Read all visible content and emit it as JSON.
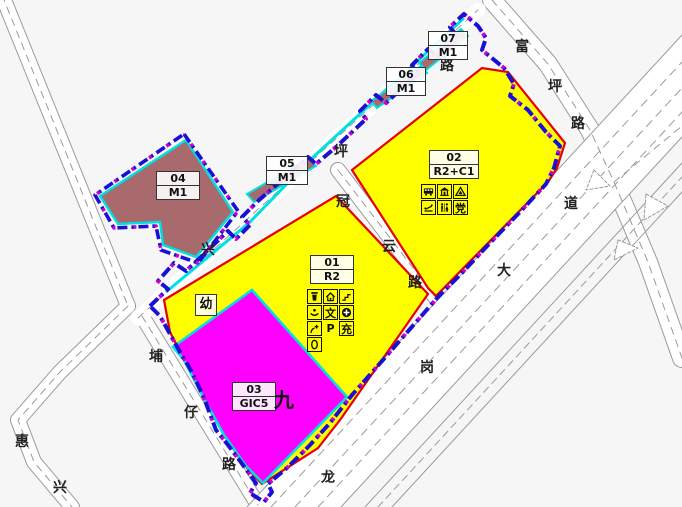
{
  "map_type": "land-use zoning plan",
  "parcels": [
    {
      "number": "01",
      "code": "R2",
      "fill": "#ffff00",
      "outline": "#e60000"
    },
    {
      "number": "02",
      "code": "R2+C1",
      "fill": "#ffff00",
      "outline": "#e60000"
    },
    {
      "number": "03",
      "code": "GIC5",
      "fill": "#ff00ff",
      "outline": "#00e0e0"
    },
    {
      "number": "04",
      "code": "M1",
      "fill": "#a96a6e",
      "outline": "#00e0e0"
    },
    {
      "number": "05",
      "code": "M1",
      "fill": "#a96a6e",
      "outline": "#00e0e0"
    },
    {
      "number": "06",
      "code": "M1",
      "fill": "#a96a6e",
      "outline": "#00e0e0"
    },
    {
      "number": "07",
      "code": "M1",
      "fill": "#a96a6e",
      "outline": "#00e0e0"
    }
  ],
  "roads": {
    "xingping": {
      "chars": [
        "兴",
        "坪",
        "路"
      ]
    },
    "guanyun": {
      "chars": [
        "冠",
        "云",
        "路"
      ]
    },
    "fuping": {
      "chars": [
        "富",
        "坪",
        "路"
      ]
    },
    "longgang": {
      "chars": [
        "龙",
        "岗",
        "大",
        "道"
      ]
    },
    "puzai": {
      "chars": [
        "埔",
        "仔",
        "路"
      ]
    },
    "huixing": {
      "chars": [
        "惠",
        "兴"
      ]
    }
  },
  "annotations": {
    "kindergarten": "幼",
    "school_nine": "九"
  },
  "facilities": {
    "parcel01": {
      "culture": "文",
      "parking": "P",
      "charging": "充",
      "pictorial": [
        "trash-bin",
        "home",
        "slope",
        "smiley",
        "plus-circle",
        "clinic-cross",
        "oval"
      ]
    },
    "parcel02": {
      "party": "党",
      "pictorial": [
        "bus",
        "pavilion",
        "triangle",
        "fitness",
        "toilet"
      ]
    }
  },
  "colors": {
    "parcel_yellow": "#ffff00",
    "parcel_magenta": "#ff00ff",
    "parcel_brown": "#a96a6e",
    "red_line": "#e60000",
    "cyan_line": "#00e0e0",
    "boundary_blue": "#1b0fd6",
    "boundary_magenta": "#cf00cf",
    "road_gray": "#9b9b9b",
    "background": "#f6f6f6"
  }
}
